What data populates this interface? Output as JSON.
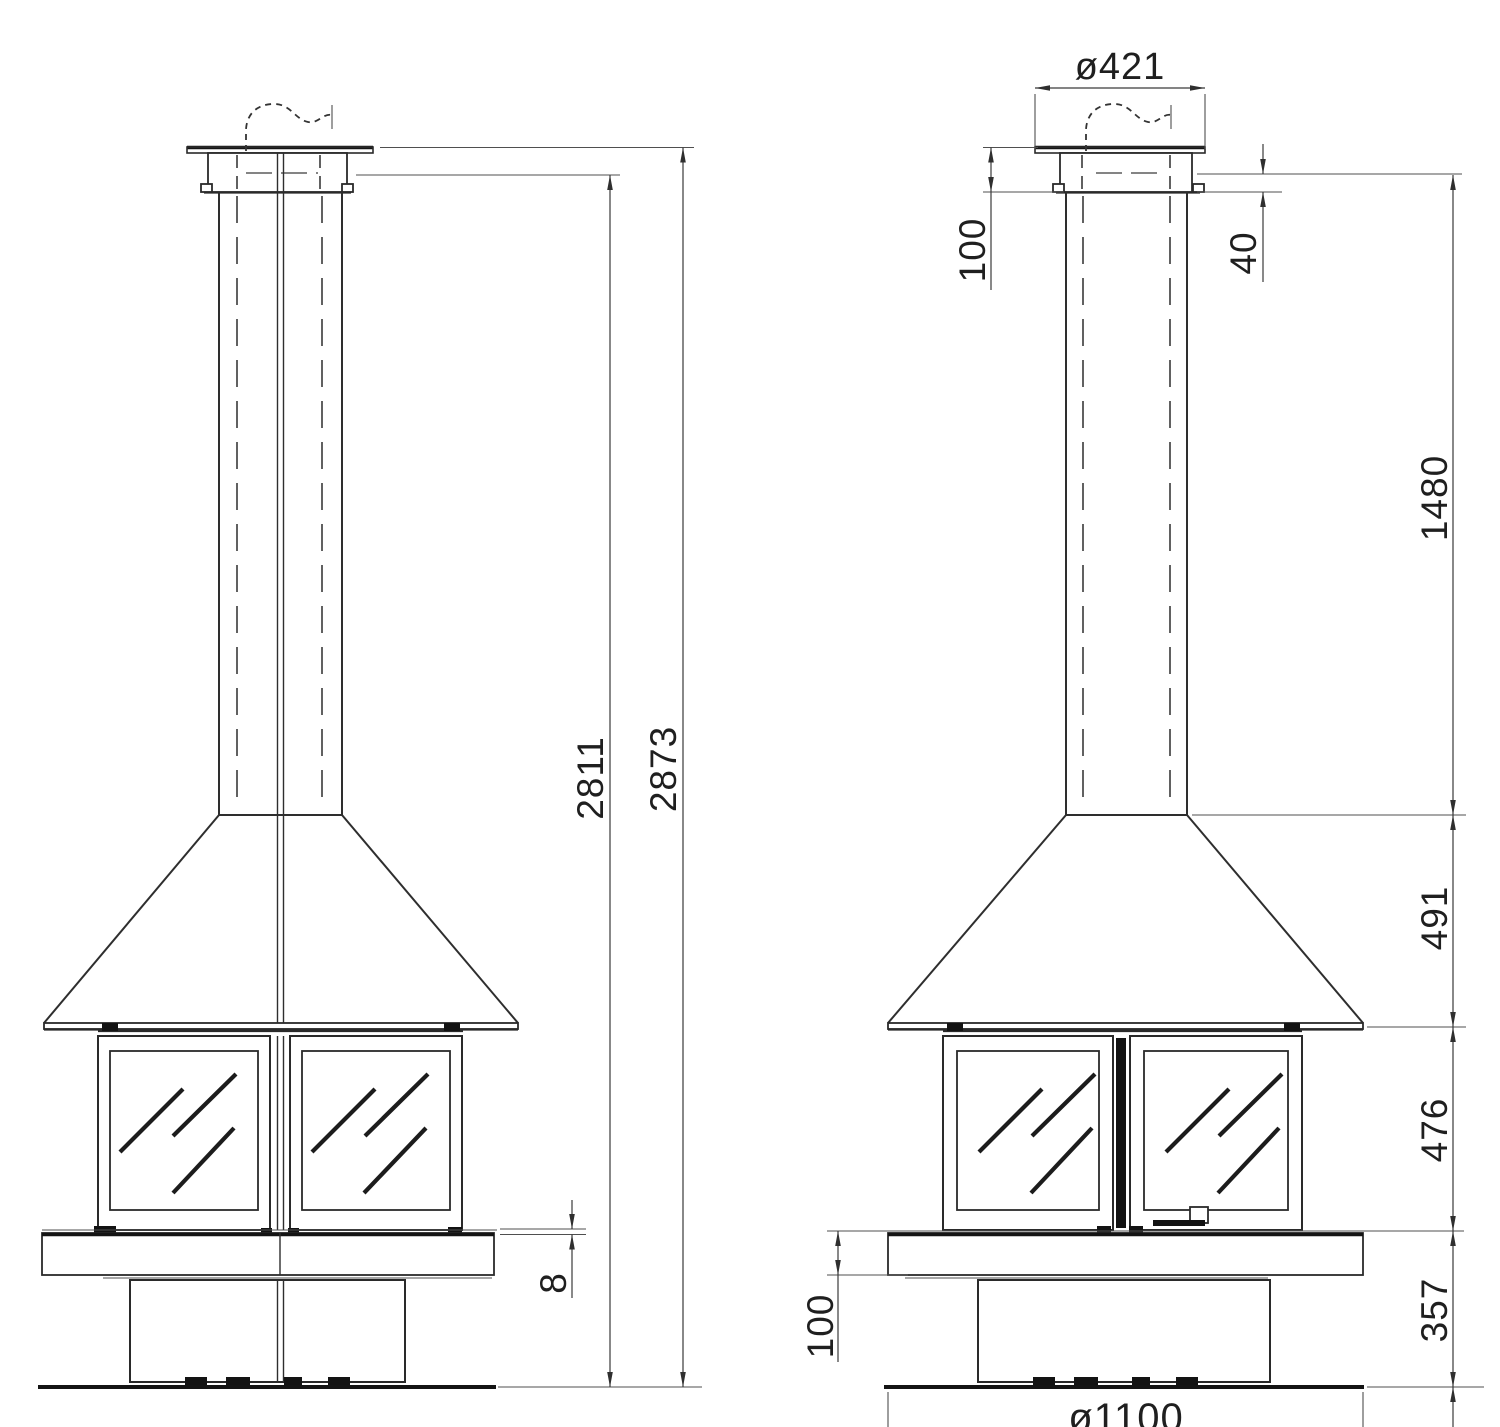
{
  "dimensions": {
    "front_view": {
      "firebox_to_bench_gap": "8",
      "height_to_cap_underside": "2811",
      "total_height": "2873"
    },
    "side_view": {
      "cap_diameter": "ø421",
      "cap_height": "100",
      "cap_rim_height": "40",
      "flue_length": "1480",
      "hood_height": "491",
      "firebox_height": "476",
      "base_height": "357",
      "bench_height": "100",
      "base_diameter": "ø1100"
    }
  }
}
